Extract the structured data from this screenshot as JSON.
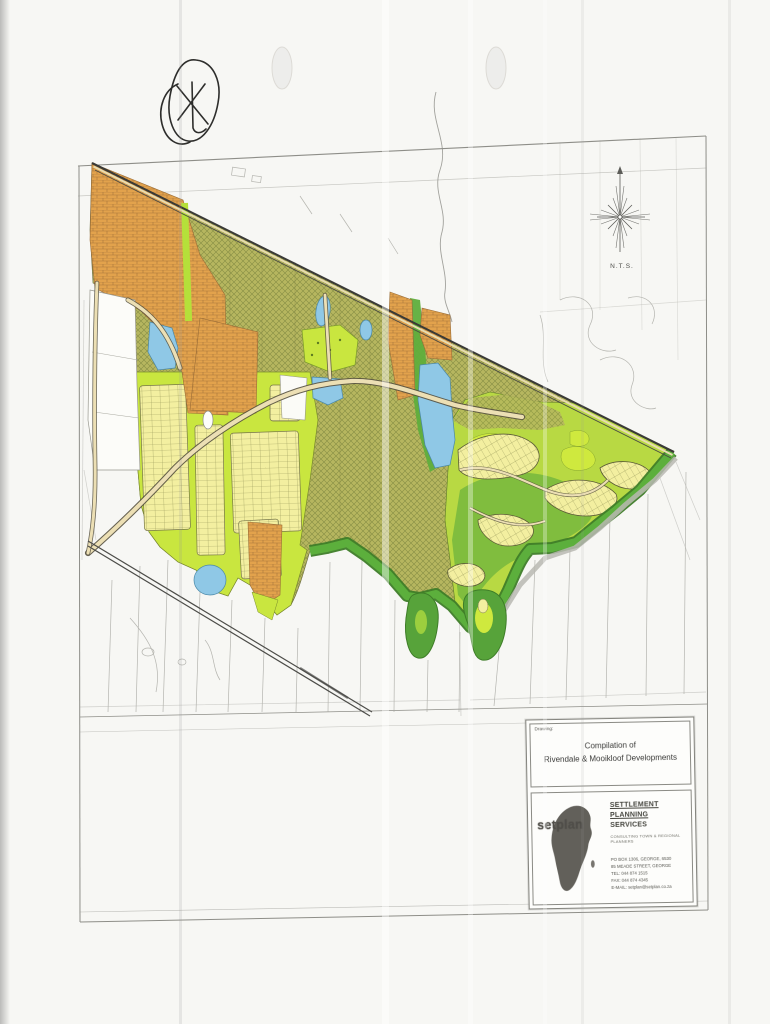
{
  "compass": {
    "label": "N.T.S."
  },
  "title_block": {
    "drawing_label": "Drawing:",
    "title_line1": "Compilation of",
    "title_line2": "Rivendale & Mooikloof Developments"
  },
  "firm": {
    "logo_text": "setplan",
    "name_line1": "SETTLEMENT PLANNING",
    "name_line2": "SERVICES",
    "tagline": "CONSULTING TOWN & REGIONAL PLANNERS",
    "address_lines": [
      "PO BOX 1306, GEORGE, 6530",
      "85 MEADE STREET, GEORGE",
      "TEL: 044 874 1515",
      "FAX: 044 874 4345",
      "E-MAIL: setplan@setplan.co.za"
    ]
  },
  "map_colors": {
    "orange_zone": "#e2a24c",
    "olive_zone": "#b6b65f",
    "lime_zone": "#c9e63f",
    "yellow_lots": "#f3efa0",
    "green_open_space": "#57a33a",
    "dark_green_edge": "#3e7d28",
    "water": "#8fc8e6",
    "road": "#ecdfb4",
    "linework": "#9a9a94"
  }
}
